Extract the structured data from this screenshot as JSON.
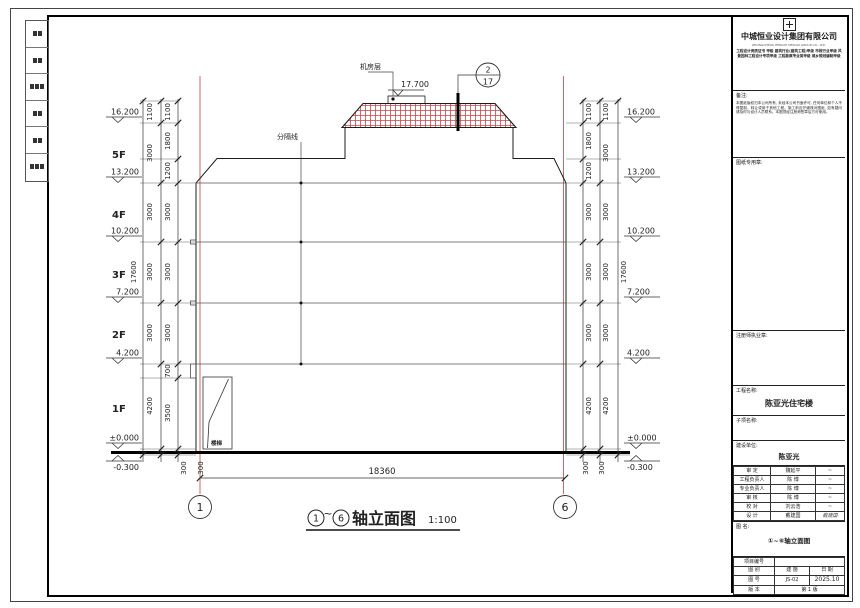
{
  "titleblock": {
    "company": "中城恒业设计集团有限公司",
    "company_en": "ZHONGCHENG HENGYE DESIGN GROUP CO., LTD.",
    "license_text": "工程设计资质证书 甲级 建筑行业(建筑工程)甲级 市政行业甲级 风景园林工程设计专项甲级 工程勘察专业类甲级 城乡规划编制甲级",
    "note_label": "备注:",
    "note_text": "本图纸版权归本公司所有, 未经本公司书面许可, 任何单位和个人不得复制、转让或用于其他工程。施工前应仔细核对图纸, 如有疑问请及时与设计人员联系。本图须经注册师签章后方可使用。",
    "stamp_drawing_label": "图纸专用章:",
    "stamp_reg_label": "注册师执业章:",
    "project_label": "工程名称:",
    "project_name": "陈亚光住宅楼",
    "subitem_label": "子项名称:",
    "client_label": "建设单位:",
    "client_name": "陈亚光",
    "roles": [
      {
        "role": "审  定",
        "name": "魏延平",
        "sig": "~"
      },
      {
        "role": "工程负责人",
        "name": "陈  博",
        "sig": "~"
      },
      {
        "role": "专业负责人",
        "name": "陈  博",
        "sig": "~"
      },
      {
        "role": "审  核",
        "name": "陈  博",
        "sig": "~"
      },
      {
        "role": "校  对",
        "name": "刘云浩",
        "sig": "~"
      },
      {
        "role": "设  计",
        "name": "戴建国",
        "sig": "戴建国"
      }
    ],
    "drawing_name_label": "图  名:",
    "drawing_name": "①~⑥轴立面图",
    "project_no_label": "项目编号",
    "cat_label": "图  别",
    "cat_value": "建  施",
    "date_label": "日  期",
    "no_label": "图  号",
    "no_value": "JS-02",
    "date_value": "2025.10",
    "ver_label": "版  本",
    "ver_value": "第 1 版"
  },
  "drawing": {
    "title": "轴立面图",
    "title_from": "1",
    "title_to": "6",
    "title_tilde": "~",
    "scale": "1:100",
    "axis_left": "1",
    "axis_right": "6",
    "bottom_dim": "18360",
    "total_height": "17600",
    "machine_room_label": "机房层",
    "roof_elev": "17.700",
    "paint_line_label": "分隔线",
    "door_label": "楼梯",
    "detail_top": "2",
    "detail_bottom": "17",
    "floors": [
      "5F",
      "4F",
      "3F",
      "2F",
      "1F"
    ],
    "elev": [
      "16.200",
      "13.200",
      "10.200",
      "7.200",
      "4.200",
      "±0.000",
      "-0.300"
    ],
    "left_a": [
      "1100",
      "3000",
      "3000",
      "3000",
      "3000",
      "4200",
      "300"
    ],
    "left_b": [
      "1100",
      "1800",
      "1200",
      "3000",
      "3000",
      "3000",
      "700",
      "3500",
      "300"
    ],
    "right_b": [
      "1100",
      "1800",
      "1200",
      "3000",
      "3000",
      "3000",
      "4200",
      "300"
    ],
    "right_a": [
      "1100",
      "3000",
      "3000",
      "3000",
      "3000",
      "4200",
      "300"
    ]
  },
  "colors": {
    "axis_red": "#c46a6a",
    "hatch_red": "#cc4444",
    "line": "#222222"
  }
}
